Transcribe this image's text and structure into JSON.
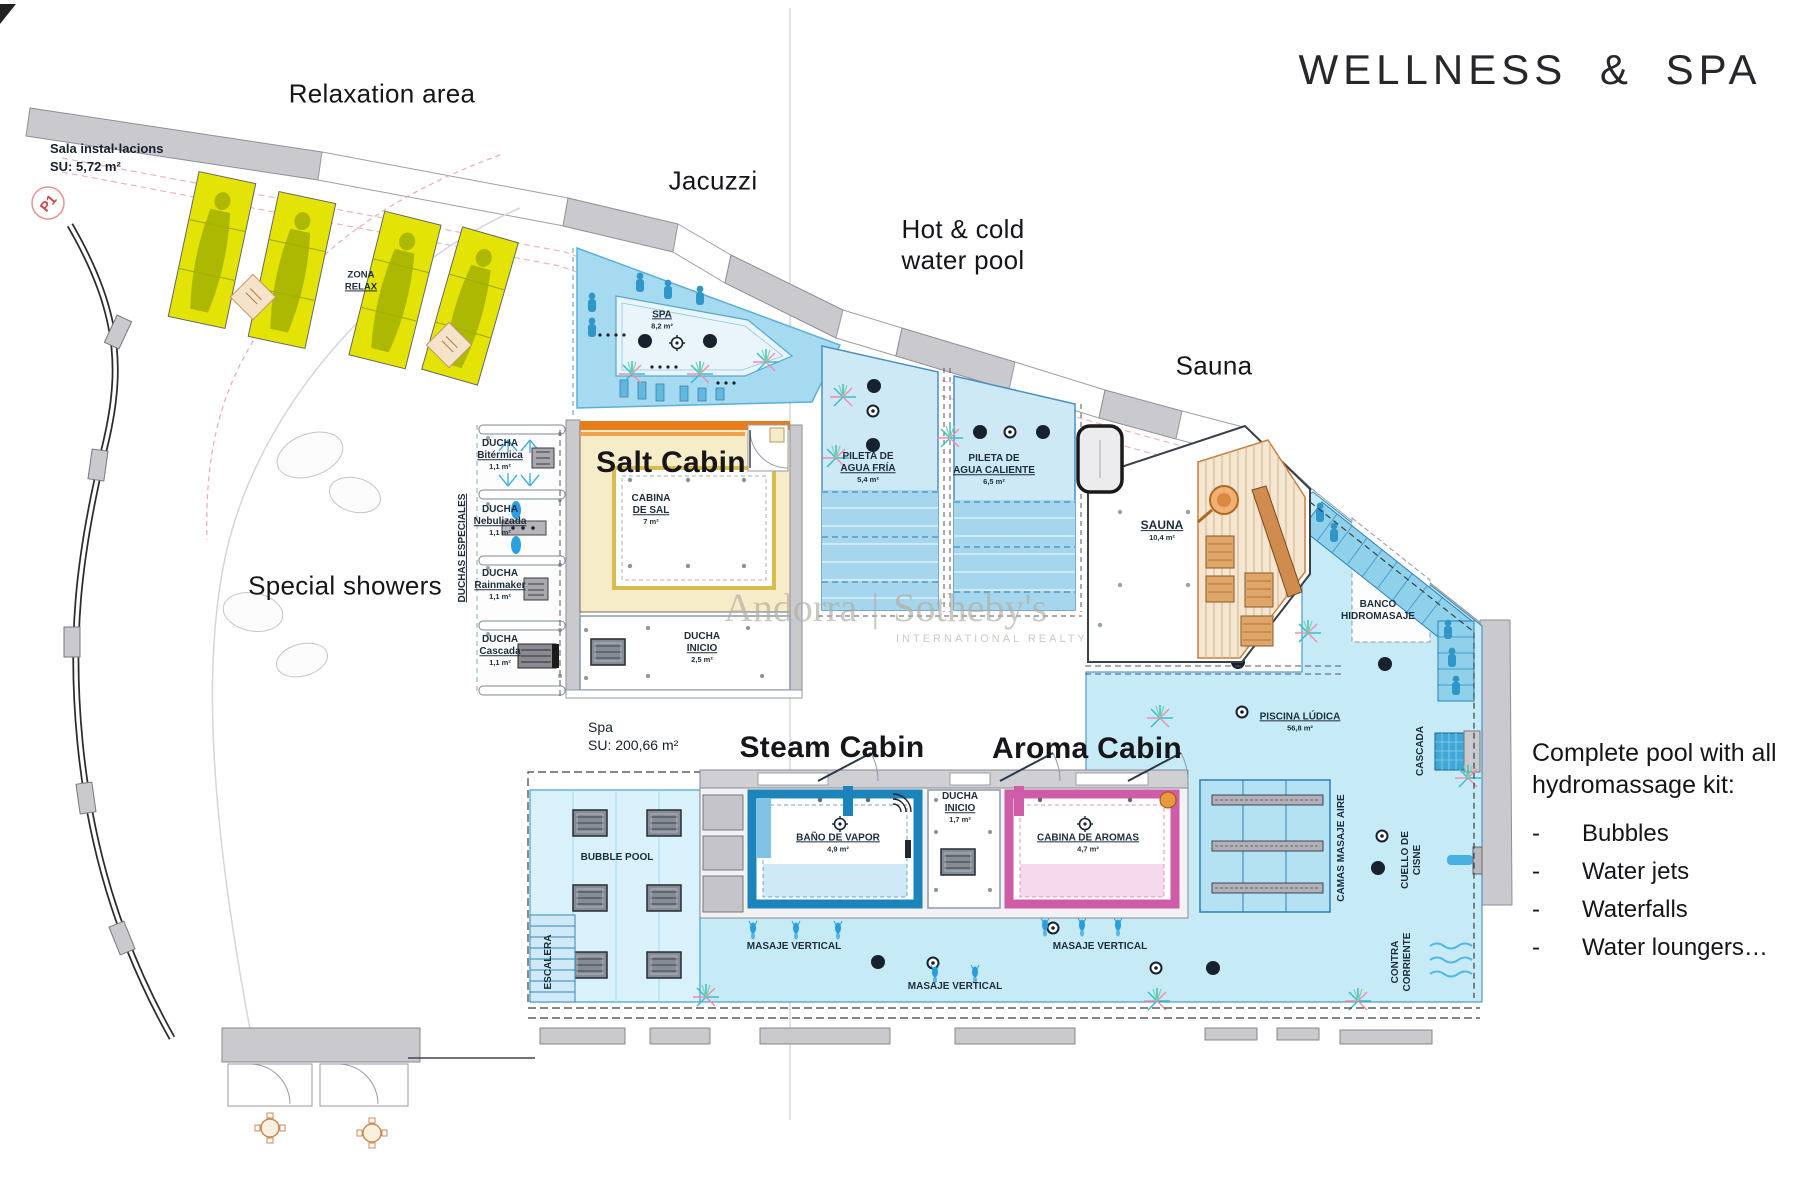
{
  "title": "WELLNESS & SPA",
  "annotations": {
    "relaxation_area": "Relaxation area",
    "jacuzzi": "Jacuzzi",
    "hot_cold_line1": "Hot & cold",
    "hot_cold_line2": "water pool",
    "sauna": "Sauna",
    "salt_cabin": "Salt Cabin",
    "special_showers": "Special showers",
    "steam_cabin": "Steam Cabin",
    "aroma_cabin": "Aroma Cabin"
  },
  "side_note": {
    "line1": "Complete pool with all",
    "line2": "hydromassage kit:",
    "bullet": "-",
    "items": [
      "Bubbles",
      "Water jets",
      "Waterfalls",
      "Water loungers…"
    ]
  },
  "rooms": {
    "sala": {
      "name": "Sala instal·lacions",
      "size": "SU: 5,72 m²"
    },
    "p1": "P1",
    "zona_relax": {
      "l1": "ZONA",
      "l2": "RELAX"
    },
    "spa_tub": {
      "name": "SPA",
      "size": "8,2 m²"
    },
    "duchas_especiales": "DUCHAS ESPECIALES",
    "ducha_bitermica": {
      "l1": "DUCHA",
      "l2": "Bitérmica",
      "size": "1,1 m²"
    },
    "ducha_nebulizada": {
      "l1": "DUCHA",
      "l2": "Nebulizada",
      "size": "1,1 m²"
    },
    "ducha_rainmaker": {
      "l1": "DUCHA",
      "l2": "Rainmaker",
      "size": "1,1 m²"
    },
    "ducha_cascada": {
      "l1": "DUCHA",
      "l2": "Cascada",
      "size": "1,1 m²"
    },
    "cabina_sal": {
      "l1": "CABINA",
      "l2": "DE SAL",
      "size": "7 m²"
    },
    "ducha_inicio_salt": {
      "l1": "DUCHA",
      "l2": "INICIO",
      "size": "2,5 m²"
    },
    "pileta_fria": {
      "l1": "PILETA DE",
      "l2": "AGUA FRÍA",
      "size": "5,4 m²"
    },
    "pileta_caliente": {
      "l1": "PILETA DE",
      "l2": "AGUA CALIENTE",
      "size": "6,5 m²"
    },
    "sauna_room": {
      "name": "SAUNA",
      "size": "10,4 m²"
    },
    "banco": {
      "l1": "BANCO",
      "l2": "HIDROMASAJE"
    },
    "piscina_ludica": {
      "name": "PISCINA LÚDICA",
      "size": "56,8 m²"
    },
    "cascada": "CASCADA",
    "camas": "CAMAS MASAJE AIRE",
    "cuello": {
      "l1": "CUELLO DE",
      "l2": "CISNE"
    },
    "contra": {
      "l1": "CONTRA",
      "l2": "CORRIENTE"
    },
    "spa_zone": {
      "name": "Spa",
      "size": "SU: 200,66 m²"
    },
    "bubble_pool": "BUBBLE POOL",
    "bano_vapor": {
      "name": "BAÑO DE VAPOR",
      "size": "4,9 m²"
    },
    "ducha_inicio_center": {
      "l1": "DUCHA",
      "l2": "INICIO",
      "size": "1,7 m²"
    },
    "cabina_aromas": {
      "name": "CABINA DE AROMAS",
      "size": "4,7 m²"
    },
    "masaje_vertical": "MASAJE VERTICAL",
    "escalera": "ESCALERA"
  },
  "watermark": {
    "left": "Andorra",
    "divider": "|",
    "right": "Sotheby's",
    "sub": "INTERNATIONAL REALTY"
  },
  "colors": {
    "pool_blue": "#c7ebf6",
    "jacuzzi_blue": "#a5daf0",
    "steam_blue": "#1b85bb",
    "aroma_pink": "#cf5ca6",
    "salt_fill": "#f7ecc8",
    "salt_trim": "#e77d1c",
    "lounger_yellow": "#e3e405",
    "wall_gray": "#c9c9ce",
    "p1_red": "#cf4646"
  }
}
